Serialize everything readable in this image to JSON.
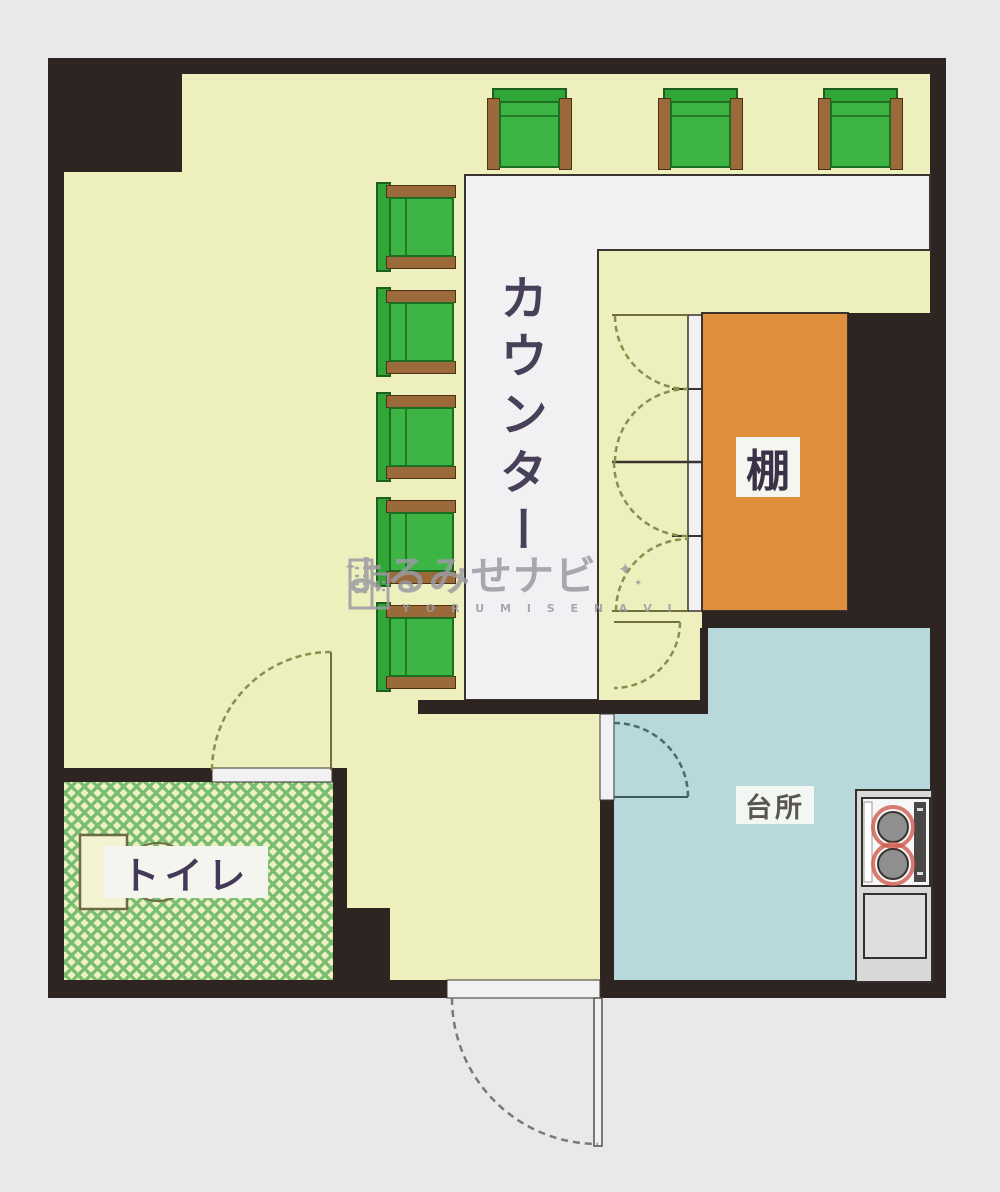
{
  "watermark": {
    "brand_jp": "よるみせナビ",
    "brand_en": "Y O R U M I S E N A V I",
    "sparkle": "✦"
  },
  "rooms": {
    "counter": {
      "label": "カウンター"
    },
    "shelf": {
      "label": "棚"
    },
    "kitchen": {
      "label": "台所"
    },
    "toilet": {
      "label": "トイレ"
    }
  },
  "furniture": {
    "stools": [
      {
        "x": 487,
        "y": 88,
        "w": 85,
        "h": 82,
        "facing": "down"
      },
      {
        "x": 658,
        "y": 88,
        "w": 85,
        "h": 82,
        "facing": "down"
      },
      {
        "x": 818,
        "y": 88,
        "w": 85,
        "h": 82,
        "facing": "down"
      },
      {
        "x": 376,
        "y": 185,
        "w": 80,
        "h": 84,
        "facing": "right"
      },
      {
        "x": 376,
        "y": 290,
        "w": 80,
        "h": 84,
        "facing": "right"
      },
      {
        "x": 376,
        "y": 395,
        "w": 80,
        "h": 84,
        "facing": "right"
      },
      {
        "x": 376,
        "y": 500,
        "w": 80,
        "h": 84,
        "facing": "right"
      },
      {
        "x": 376,
        "y": 605,
        "w": 80,
        "h": 84,
        "facing": "right"
      }
    ],
    "stove": {
      "burners": 2
    }
  },
  "colors": {
    "paper": "#e9e9ec",
    "wall": "#2e2522",
    "floor": "#edefbc",
    "counter": "#f1f1f3",
    "shelf": "#e0903c",
    "kitchen": "#b7d9dc",
    "toilet_base": "#eff1c4",
    "toilet_lattice": "#79bd70",
    "stool_seat": "#3cb544",
    "stool_back": "#2fa636",
    "stool_arm": "#9a6a3a",
    "stove_body": "#d8d8d8",
    "burner": "#8f8f8f",
    "burner_ring": "#cd5a4e",
    "door_arc": "#8a8f4a",
    "label_text": "#474058",
    "watermark": "#9b9ba3"
  }
}
